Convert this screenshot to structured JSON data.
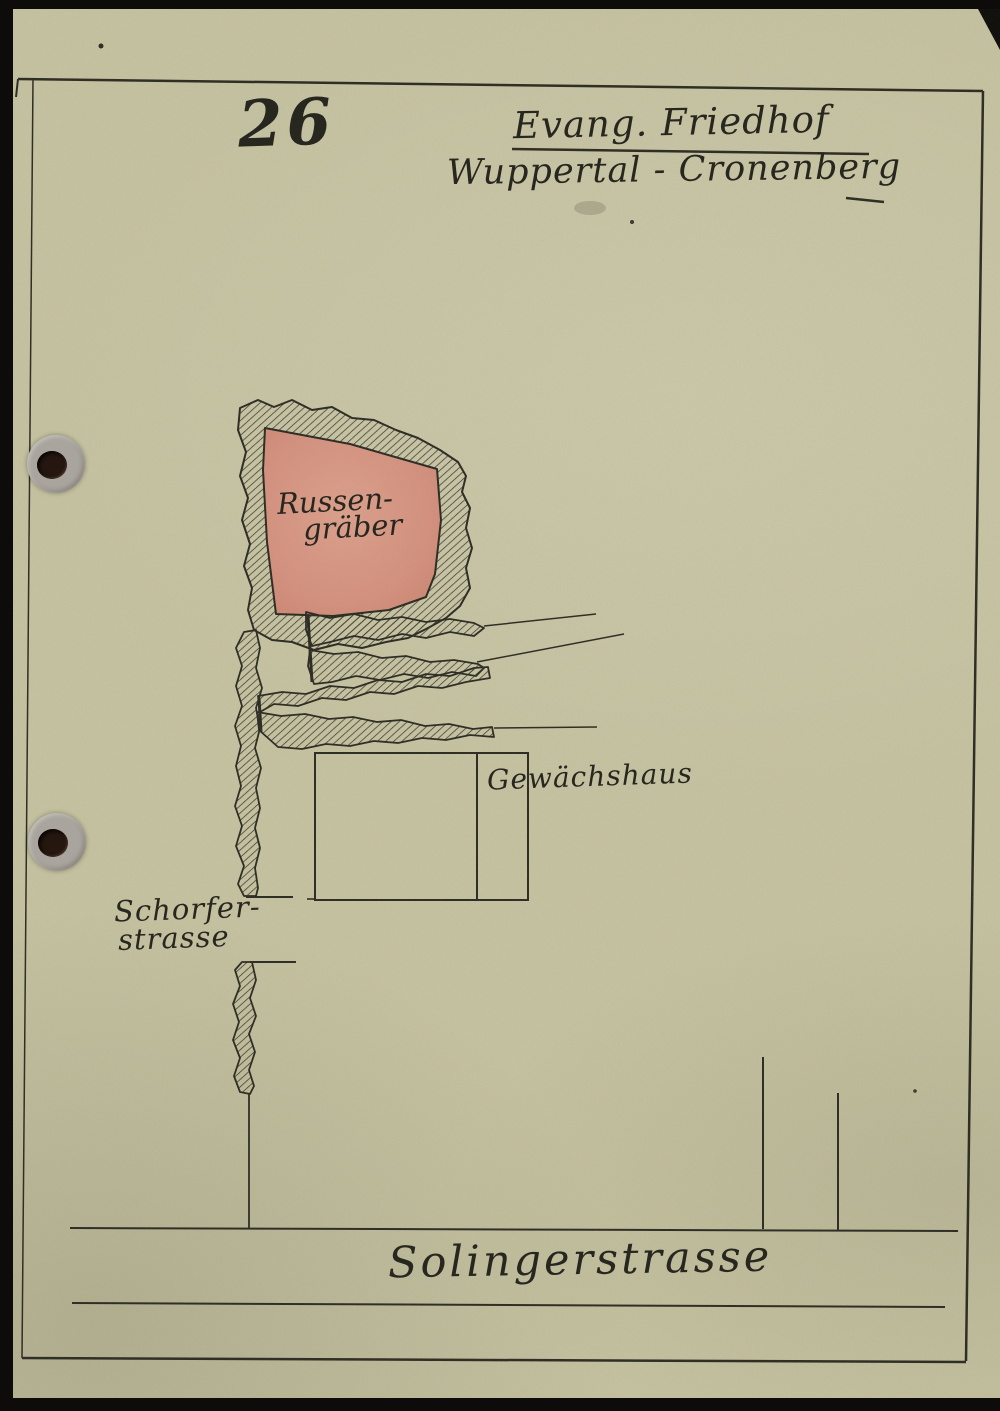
{
  "document": {
    "page_number": "26",
    "title": "Evang. Friedhof",
    "location": "Wuppertal - Cronenberg"
  },
  "map": {
    "grave_area": {
      "label_line1": "Russen-",
      "label_line2": "gräber"
    },
    "greenhouse": {
      "label": "Gewächshaus"
    },
    "streets": {
      "west_line1": "Schorfer-",
      "west_line2": "strasse",
      "south": "Solingerstrasse"
    }
  },
  "artifacts": {
    "hole_punch_count": 2
  },
  "colors": {
    "paper": "#c6c3a2",
    "ink": "#28271f",
    "grave_area_fill": "#d5917f",
    "surround_black": "#0d0c0a",
    "hole_ring": "#a9a59e",
    "hole_center": "#261610"
  }
}
